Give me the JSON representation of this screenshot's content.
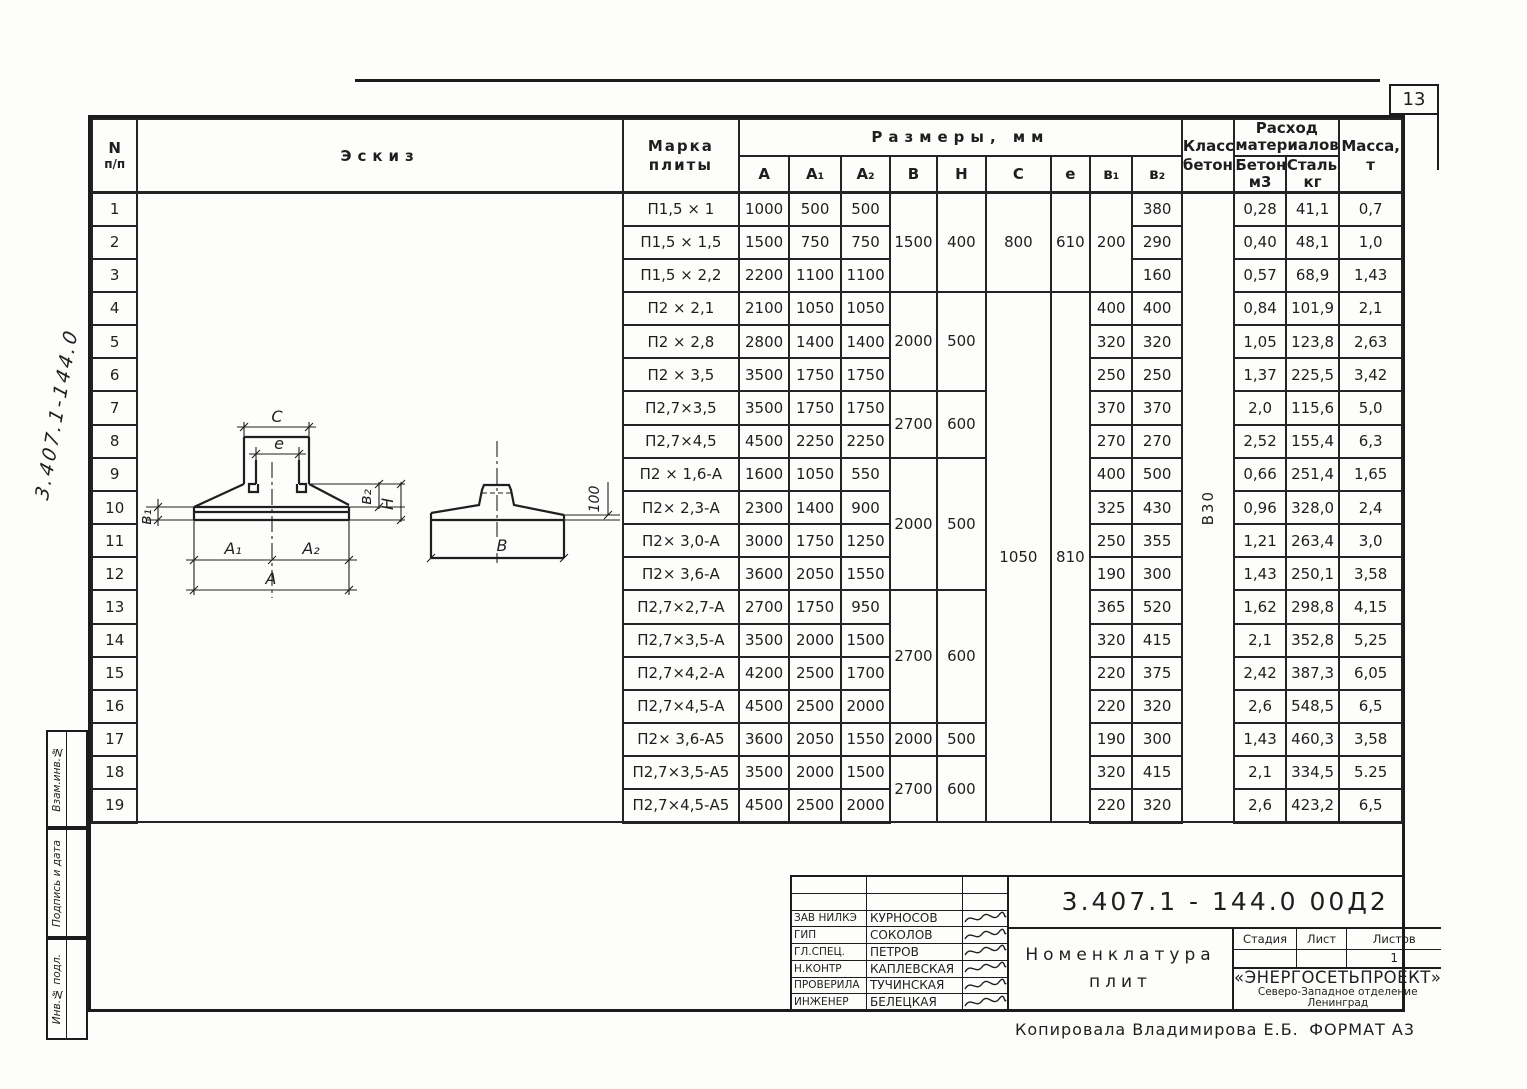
{
  "page": {
    "number": "13",
    "copied_by": "Копировала  Владимирова Е.Б.",
    "format": "ФОРМАТ А3",
    "side_doc_number": "3.407.1-144.0",
    "side_fields": [
      "Взам.инв.№",
      "Подпись и дата",
      "Инв.№ подл."
    ]
  },
  "table": {
    "headers": {
      "num_1": "N",
      "num_2": "п/п",
      "eskiz": "Эскиз",
      "mark_1": "Марка",
      "mark_2": "плиты",
      "sizes": "Размеры,  мм",
      "dims": [
        "А",
        "А₁",
        "А₂",
        "В",
        "Н",
        "С",
        "е",
        "в₁",
        "в₂"
      ],
      "klass_1": "Класс",
      "klass_2": "бетона",
      "rashod_1": "Расход",
      "rashod_2": "материалов",
      "beton": "Бетон, м3",
      "stal": "Сталь, кг",
      "massa_1": "Масса,",
      "massa_2": "т"
    },
    "concrete_class": "В30",
    "rows": [
      {
        "n": "1",
        "mark": "П1,5 × 1",
        "dims": [
          "1000",
          "500",
          "500",
          {
            "v": "1500",
            "rs": 3
          },
          {
            "v": "400",
            "rs": 3
          },
          {
            "v": "800",
            "rs": 3
          },
          {
            "v": "610",
            "rs": 3
          },
          {
            "v": "200",
            "rs": 3
          },
          "380"
        ],
        "tail": [
          "0,28",
          "41,1",
          "0,7"
        ]
      },
      {
        "n": "2",
        "mark": "П1,5 × 1,5",
        "dims": [
          "1500",
          "750",
          "750",
          "290"
        ],
        "tail": [
          "0,40",
          "48,1",
          "1,0"
        ]
      },
      {
        "n": "3",
        "mark": "П1,5 × 2,2",
        "dims": [
          "2200",
          "1100",
          "1100",
          "160"
        ],
        "tail": [
          "0,57",
          "68,9",
          "1,43"
        ]
      },
      {
        "n": "4",
        "mark": "П2 × 2,1",
        "dims": [
          "2100",
          "1050",
          "1050",
          {
            "v": "2000",
            "rs": 3
          },
          {
            "v": "500",
            "rs": 3
          },
          {
            "v": "1050",
            "rs": 16
          },
          {
            "v": "810",
            "rs": 16
          },
          "400",
          "400"
        ],
        "tail": [
          "0,84",
          "101,9",
          "2,1"
        ]
      },
      {
        "n": "5",
        "mark": "П2 × 2,8",
        "dims": [
          "2800",
          "1400",
          "1400",
          "320",
          "320"
        ],
        "tail": [
          "1,05",
          "123,8",
          "2,63"
        ]
      },
      {
        "n": "6",
        "mark": "П2 × 3,5",
        "dims": [
          "3500",
          "1750",
          "1750",
          "250",
          "250"
        ],
        "tail": [
          "1,37",
          "225,5",
          "3,42"
        ]
      },
      {
        "n": "7",
        "mark": "П2,7×3,5",
        "dims": [
          "3500",
          "1750",
          "1750",
          {
            "v": "2700",
            "rs": 2
          },
          {
            "v": "600",
            "rs": 2
          },
          "370",
          "370"
        ],
        "tail": [
          "2,0",
          "115,6",
          "5,0"
        ]
      },
      {
        "n": "8",
        "mark": "П2,7×4,5",
        "dims": [
          "4500",
          "2250",
          "2250",
          "270",
          "270"
        ],
        "tail": [
          "2,52",
          "155,4",
          "6,3"
        ]
      },
      {
        "n": "9",
        "mark": "П2 × 1,6-А",
        "dims": [
          "1600",
          "1050",
          "550",
          {
            "v": "2000",
            "rs": 4
          },
          {
            "v": "500",
            "rs": 4
          },
          "400",
          "500"
        ],
        "tail": [
          "0,66",
          "251,4",
          "1,65"
        ]
      },
      {
        "n": "10",
        "mark": "П2× 2,3-А",
        "dims": [
          "2300",
          "1400",
          "900",
          "325",
          "430"
        ],
        "tail": [
          "0,96",
          "328,0",
          "2,4"
        ]
      },
      {
        "n": "11",
        "mark": "П2× 3,0-А",
        "dims": [
          "3000",
          "1750",
          "1250",
          "250",
          "355"
        ],
        "tail": [
          "1,21",
          "263,4",
          "3,0"
        ]
      },
      {
        "n": "12",
        "mark": "П2× 3,6-А",
        "dims": [
          "3600",
          "2050",
          "1550",
          "190",
          "300"
        ],
        "tail": [
          "1,43",
          "250,1",
          "3,58"
        ]
      },
      {
        "n": "13",
        "mark": "П2,7×2,7-А",
        "dims": [
          "2700",
          "1750",
          "950",
          {
            "v": "2700",
            "rs": 4
          },
          {
            "v": "600",
            "rs": 4
          },
          "365",
          "520"
        ],
        "tail": [
          "1,62",
          "298,8",
          "4,15"
        ]
      },
      {
        "n": "14",
        "mark": "П2,7×3,5-А",
        "dims": [
          "3500",
          "2000",
          "1500",
          "320",
          "415"
        ],
        "tail": [
          "2,1",
          "352,8",
          "5,25"
        ]
      },
      {
        "n": "15",
        "mark": "П2,7×4,2-А",
        "dims": [
          "4200",
          "2500",
          "1700",
          "220",
          "375"
        ],
        "tail": [
          "2,42",
          "387,3",
          "6,05"
        ]
      },
      {
        "n": "16",
        "mark": "П2,7×4,5-А",
        "dims": [
          "4500",
          "2500",
          "2000",
          "220",
          "320"
        ],
        "tail": [
          "2,6",
          "548,5",
          "6,5"
        ]
      },
      {
        "n": "17",
        "mark": "П2× 3,6-А5",
        "dims": [
          "3600",
          "2050",
          "1550",
          "2000",
          "500",
          "190",
          "300"
        ],
        "tail": [
          "1,43",
          "460,3",
          "3,58"
        ]
      },
      {
        "n": "18",
        "mark": "П2,7×3,5-А5",
        "dims": [
          "3500",
          "2000",
          "1500",
          {
            "v": "2700",
            "rs": 2
          },
          {
            "v": "600",
            "rs": 2
          },
          "320",
          "415"
        ],
        "tail": [
          "2,1",
          "334,5",
          "5.25"
        ]
      },
      {
        "n": "19",
        "mark": "П2,7×4,5-А5",
        "dims": [
          "4500",
          "2500",
          "2000",
          "220",
          "320"
        ],
        "tail": [
          "2,6",
          "423,2",
          "6,5"
        ]
      }
    ]
  },
  "sketch": {
    "labels": {
      "c": "С",
      "e": "е",
      "b1": "в₁",
      "b2": "в₂",
      "h": "Н",
      "a1": "А₁",
      "a2": "А₂",
      "a": "А",
      "b": "В",
      "edge": "100"
    }
  },
  "title_block": {
    "doc_number": "3.407.1 - 144.0    00Д2",
    "title_1": "Номенклатура",
    "title_2": "плит",
    "stage_label": "Стадия",
    "sheet_label": "Лист",
    "sheets_label": "Листов",
    "sheets_value": "1",
    "org_1": "«ЭНЕРГОСЕТЬПРОЕКТ»",
    "org_2": "Северо-Западное отделение",
    "org_3": "Ленинград",
    "signers": [
      {
        "role": "Зав НИЛКЭ",
        "name": "Курносов"
      },
      {
        "role": "ГИП",
        "name": "Соколов"
      },
      {
        "role": "Гл.спец.",
        "name": "Петров"
      },
      {
        "role": "Н.контр",
        "name": "Каплевская"
      },
      {
        "role": "Проверила",
        "name": "Тучинская"
      },
      {
        "role": "Инженер",
        "name": "Белецкая"
      }
    ]
  }
}
